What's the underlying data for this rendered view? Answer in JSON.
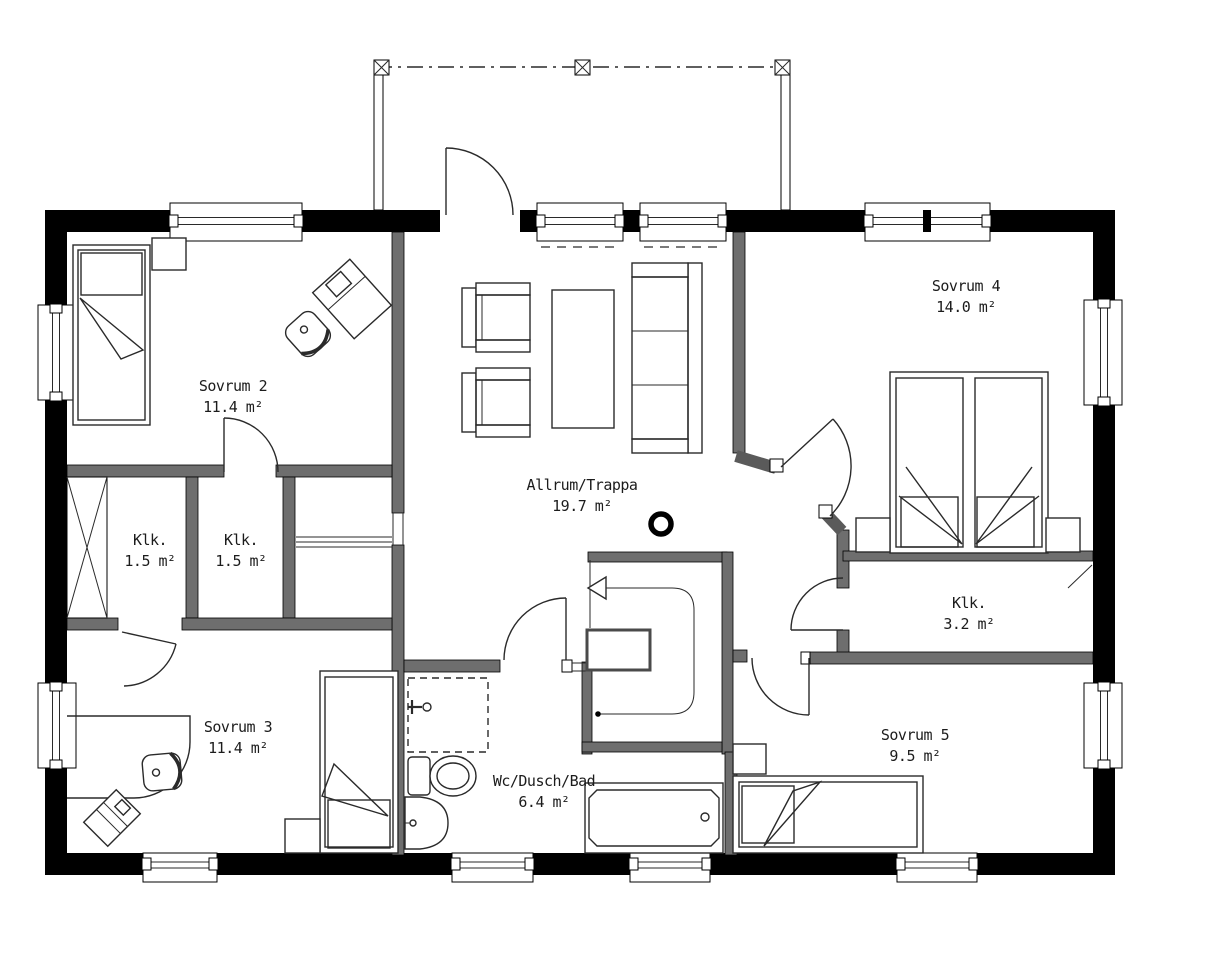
{
  "plan": {
    "type": "floor-plan",
    "language": "Swedish",
    "colors": {
      "background": "#ffffff",
      "exterior_wall": "#000000",
      "interior_wall": "#6e6e6e",
      "line": "#2a2a2a"
    }
  },
  "rooms": [
    {
      "id": "sovrum2",
      "name": "Sovrum 2",
      "area": "11.4 m²"
    },
    {
      "id": "sovrum4",
      "name": "Sovrum 4",
      "area": "14.0 m²"
    },
    {
      "id": "klk_a",
      "name": "Klk.",
      "area": "1.5 m²"
    },
    {
      "id": "klk_b",
      "name": "Klk.",
      "area": "1.5 m²"
    },
    {
      "id": "allrum",
      "name": "Allrum/Trappa",
      "area": "19.7 m²"
    },
    {
      "id": "klk_c",
      "name": "Klk.",
      "area": "3.2 m²"
    },
    {
      "id": "sovrum3",
      "name": "Sovrum 3",
      "area": "11.4 m²"
    },
    {
      "id": "wc",
      "name": "Wc/Dusch/Bad",
      "area": "6.4 m²"
    },
    {
      "id": "sovrum5",
      "name": "Sovrum 5",
      "area": "9.5 m²"
    }
  ]
}
